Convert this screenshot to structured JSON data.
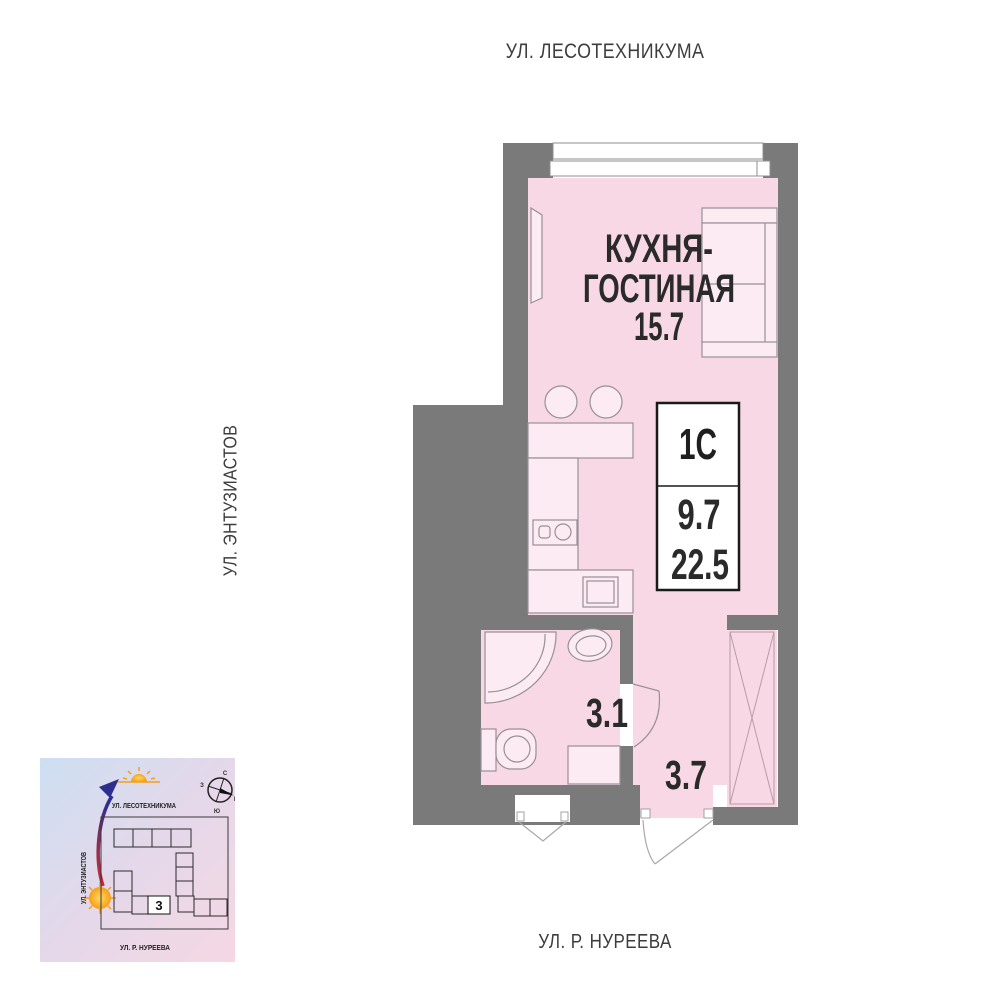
{
  "streets": {
    "top": "УЛ. ЛЕСОТЕХНИКУМА",
    "left": "УЛ. ЭНТУЗИАСТОВ",
    "bottom": "УЛ. Р. НУРЕЕВА"
  },
  "plan": {
    "room": {
      "title_line1": "КУХНЯ-",
      "title_line2": "ГОСТИНАЯ",
      "area": "15.7"
    },
    "bathroom": {
      "area": "3.1"
    },
    "hallway": {
      "area": "3.7"
    },
    "info_card": {
      "layout_type": "1C",
      "living_area": "9.7",
      "total_area": "22.5"
    }
  },
  "minimap": {
    "street_top": "УЛ. ЛЕСОТЕХНИКУМА",
    "street_left": "УЛ. ЭНТУЗИАСТОВ",
    "street_bottom": "УЛ. Р. НУРЕЕВА",
    "building_number": "3",
    "compass": {
      "north": "С",
      "south": "Ю",
      "west": "З",
      "east": "В"
    }
  },
  "colors": {
    "wall": "#7a7a7a",
    "room_fill": "#f8d8e5",
    "fixture_fill": "#fcebf2",
    "text": "#2a2a2a",
    "arrow_red": "#d42a2e",
    "arrow_blue": "#2e2e8f",
    "sun": "#f59f1a"
  }
}
